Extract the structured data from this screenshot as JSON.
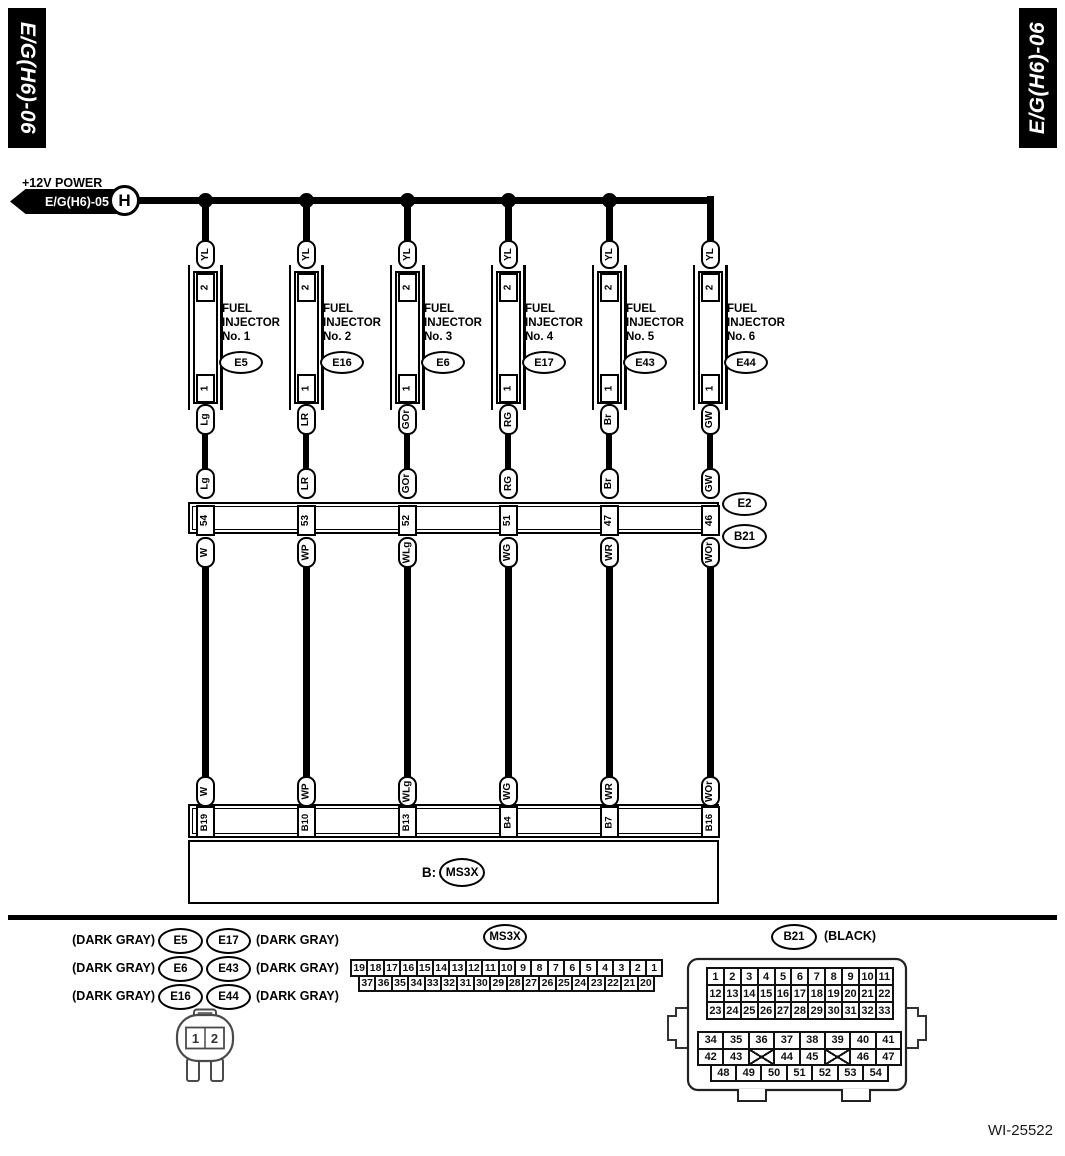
{
  "header": {
    "tab_left": "E/G(H6)-06",
    "tab_right": "E/G(H6)-06"
  },
  "power": {
    "label": "+12V POWER",
    "ref": "E/G(H6)-05",
    "node": "H"
  },
  "circuit": {
    "columns": [
      {
        "title1": "FUEL",
        "title2": "INJECTOR",
        "no": "No. 1",
        "connector": "E5",
        "pin_top": "2",
        "pin_bottom": "1",
        "supply": "YL",
        "injector_wire": "Lg",
        "joint_pin": "54",
        "ecu_wire": "W",
        "ecu_pin": "B19"
      },
      {
        "title1": "FUEL",
        "title2": "INJECTOR",
        "no": "No. 2",
        "connector": "E16",
        "pin_top": "2",
        "pin_bottom": "1",
        "supply": "YL",
        "injector_wire": "LR",
        "joint_pin": "53",
        "ecu_wire": "WP",
        "ecu_pin": "B10"
      },
      {
        "title1": "FUEL",
        "title2": "INJECTOR",
        "no": "No. 3",
        "connector": "E6",
        "pin_top": "2",
        "pin_bottom": "1",
        "supply": "YL",
        "injector_wire": "GOr",
        "joint_pin": "52",
        "ecu_wire": "WLg",
        "ecu_pin": "B13"
      },
      {
        "title1": "FUEL",
        "title2": "INJECTOR",
        "no": "No. 4",
        "connector": "E17",
        "pin_top": "2",
        "pin_bottom": "1",
        "supply": "YL",
        "injector_wire": "RG",
        "joint_pin": "51",
        "ecu_wire": "WG",
        "ecu_pin": "B4"
      },
      {
        "title1": "FUEL",
        "title2": "INJECTOR",
        "no": "No. 5",
        "connector": "E43",
        "pin_top": "2",
        "pin_bottom": "1",
        "supply": "YL",
        "injector_wire": "Br",
        "joint_pin": "47",
        "ecu_wire": "WR",
        "ecu_pin": "B7"
      },
      {
        "title1": "FUEL",
        "title2": "INJECTOR",
        "no": "No. 6",
        "connector": "E44",
        "pin_top": "2",
        "pin_bottom": "1",
        "supply": "YL",
        "injector_wire": "GW",
        "joint_pin": "46",
        "ecu_wire": "WOr",
        "ecu_pin": "B16"
      }
    ],
    "joint_connector": {
      "upper": "E2",
      "lower": "B21"
    },
    "ecu": {
      "prefix": "B:",
      "name": "MS3X"
    }
  },
  "legend": {
    "rows": [
      {
        "left_note": "(DARK GRAY)",
        "left": "E5",
        "right": "E17",
        "right_note": "(DARK GRAY)"
      },
      {
        "left_note": "(DARK GRAY)",
        "left": "E6",
        "right": "E43",
        "right_note": "(DARK GRAY)"
      },
      {
        "left_note": "(DARK GRAY)",
        "left": "E16",
        "right": "E44",
        "right_note": "(DARK GRAY)"
      }
    ],
    "plug_pins": [
      "1",
      "2"
    ]
  },
  "ms3x": {
    "name": "MS3X",
    "row1": [
      "19",
      "18",
      "17",
      "16",
      "15",
      "14",
      "13",
      "12",
      "11",
      "10",
      "9",
      "8",
      "7",
      "6",
      "5",
      "4",
      "3",
      "2",
      "1"
    ],
    "row2": [
      "37",
      "36",
      "35",
      "34",
      "33",
      "32",
      "31",
      "30",
      "29",
      "28",
      "27",
      "26",
      "25",
      "24",
      "23",
      "22",
      "21",
      "20"
    ]
  },
  "b21": {
    "name": "B21",
    "color": "(BLACK)",
    "grid_top": [
      "1",
      "2",
      "3",
      "4",
      "5",
      "6",
      "7",
      "8",
      "9",
      "10",
      "11",
      "12",
      "13",
      "14",
      "15",
      "16",
      "17",
      "18",
      "19",
      "20",
      "21",
      "22",
      "23",
      "24",
      "25",
      "26",
      "27",
      "28",
      "29",
      "30",
      "31",
      "32",
      "33"
    ],
    "grid_mid": [
      "34",
      "35",
      "36",
      "37",
      "38",
      "39",
      "40",
      "41",
      "42",
      "43",
      "X",
      "44",
      "45",
      "X",
      "46",
      "47"
    ],
    "grid_bottom": [
      "48",
      "49",
      "50",
      "51",
      "52",
      "53",
      "54"
    ]
  },
  "footer": {
    "code": "WI-25522"
  }
}
